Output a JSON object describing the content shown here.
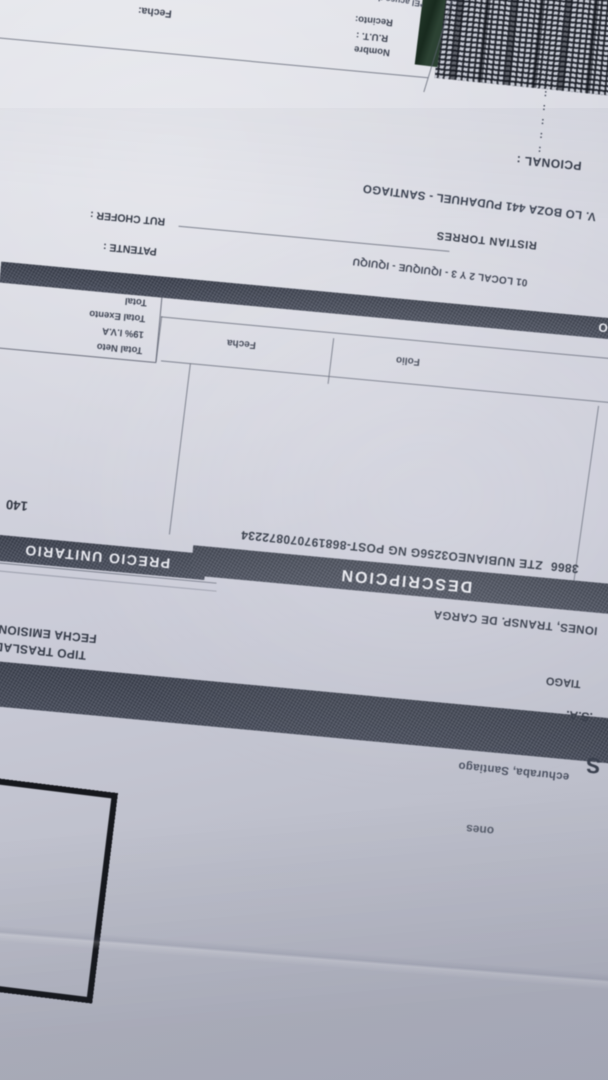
{
  "document": {
    "acuse_box": {
      "note_partial": "*El acuse de recibo qu",
      "fecha_label": "Fecha:",
      "recinto_label": "Recinto:",
      "rut_label": "R.U.T. :",
      "nombre_label": "Nombre"
    },
    "margin_colons": [
      ":",
      ":",
      ":",
      ":",
      ":"
    ],
    "opcional_label": "PCIONAL :",
    "address_line": "V. LO BOZA 441 PUDAHUEL - SANTIAGO",
    "chofer_name": "RISTIAN TORRES",
    "rut_chofer_label": "RUT CHOFER :",
    "patente_label": "PATENTE :",
    "patente_band_mark": "O",
    "sucursal_line": "01 LOCAL 2 Y 3 - IQUIQUE - IQUIQU",
    "totals": {
      "rows": [
        {
          "label": "Total Neto",
          "currency": "$"
        },
        {
          "label": "19% I.V.A",
          "currency": "$"
        },
        {
          "label": "Total Exento",
          "currency": "$"
        },
        {
          "label": "Total",
          "currency": "$"
        }
      ]
    },
    "reference_boxes": {
      "folio_label": "Folio",
      "fecha_label": "Fecha"
    },
    "item_row": {
      "code": "3866",
      "description": "ZTE NUBIANEO3256G NG POST-868197070872234",
      "unit_price_partial": "140"
    },
    "table_headers": {
      "descripcion": "DESCRIPCION",
      "precio_unitario": "PRECIO UNITARIO"
    },
    "giro_line_partial": "IONES, TRANSP. DE CARGA",
    "fecha_emision_label": "FECHA EMISION",
    "tipo_traslado_label": "TIPO TRASLAD",
    "city_partial": "TIAGO",
    "company_suffix": ".S.A.",
    "logo_letter_partial": "S",
    "address_partial": "echuraba, Santiago",
    "word_partial": "ones"
  },
  "colors": {
    "paper": "#d3d5df",
    "ink": "#343a47",
    "header_band": "#454a58",
    "band_text": "#e8e9ef",
    "barcode_dark": "#23262e",
    "rut_box_border": "#16181d",
    "green_strip": "#24392b"
  }
}
